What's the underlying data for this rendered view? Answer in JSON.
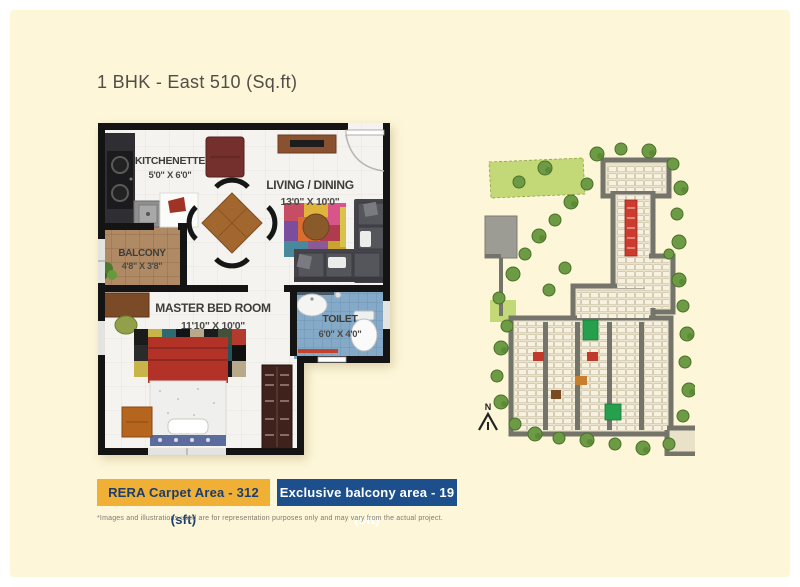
{
  "page": {
    "title": "1 BHK - East 510 (Sq.ft)",
    "footnote": "*Images and illustrations used are for representation purposes only and may vary from the actual project.",
    "colors": {
      "page_bg": "#FFFFFF",
      "panel_bg": "#FDF6D8",
      "wall": "#141414",
      "highlight_red": "#CC3B2E",
      "highlight_green": "#27A04E"
    }
  },
  "floor_plan": {
    "rooms": [
      {
        "name": "KITCHENETTE",
        "dims": "5'0\" X 6'0\""
      },
      {
        "name": "LIVING / DINING",
        "dims": "13'0\" X 10'0\""
      },
      {
        "name": "BALCONY",
        "dims": "4'8\" X 3'8\""
      },
      {
        "name": "MASTER BED ROOM",
        "dims": "11'10\" X 10'0\""
      },
      {
        "name": "TOILET",
        "dims": "6'0\" X 4'0\""
      }
    ]
  },
  "site_plan": {
    "north_label": "N"
  },
  "badges": {
    "carpet": {
      "label": "RERA Carpet Area - 312 (sft)",
      "bg": "#F0AF35",
      "fg": "#1B3E6F"
    },
    "balcony": {
      "label": "Exclusive balcony area - 19 (sft)",
      "bg": "#1D4F8C",
      "fg": "#FFFFFF"
    }
  }
}
